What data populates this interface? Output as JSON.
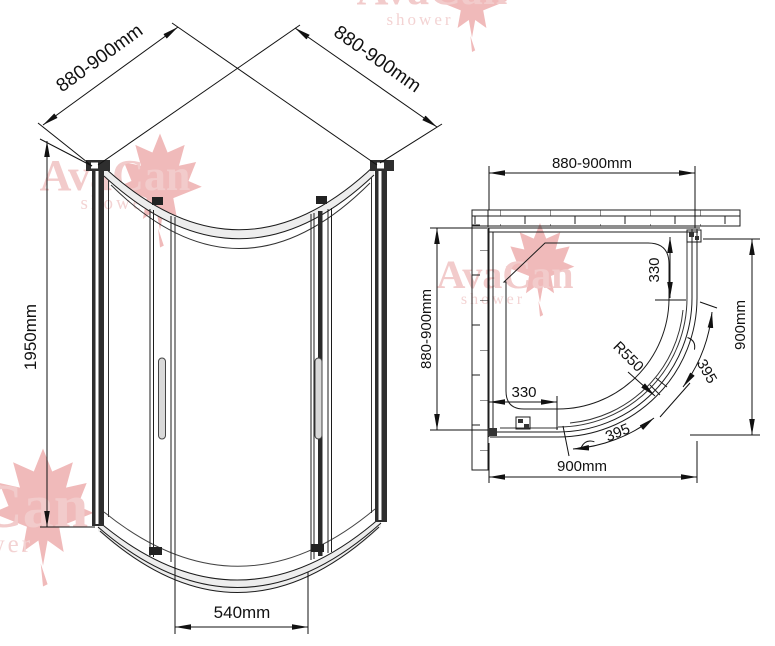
{
  "watermark": {
    "brand": "AvaCan",
    "subtitle": "shower"
  },
  "front_view": {
    "dim_width_left": "880-900mm",
    "dim_width_right": "880-900mm",
    "dim_height": "1950mm",
    "dim_door_opening": "540mm"
  },
  "plan_view": {
    "dim_width_top": "880-900mm",
    "dim_depth_left": "880-900mm",
    "dim_depth_right": "900mm",
    "dim_width_bottom": "900mm",
    "dim_side_panel_right": "330",
    "dim_side_panel_bottom": "330",
    "dim_radius": "R550",
    "dim_door_arc_right": "395",
    "dim_door_arc_bottom": "395"
  },
  "colors": {
    "line": "#1c1c1c",
    "dimension_text": "#111111",
    "profile_fill": "#2e2e2e",
    "watermark_text": "#f0c2c2",
    "watermark_leaf": "#eeafaf",
    "glass_highlight": "#ebebeb",
    "handle_fill": "#d9d9d9"
  }
}
